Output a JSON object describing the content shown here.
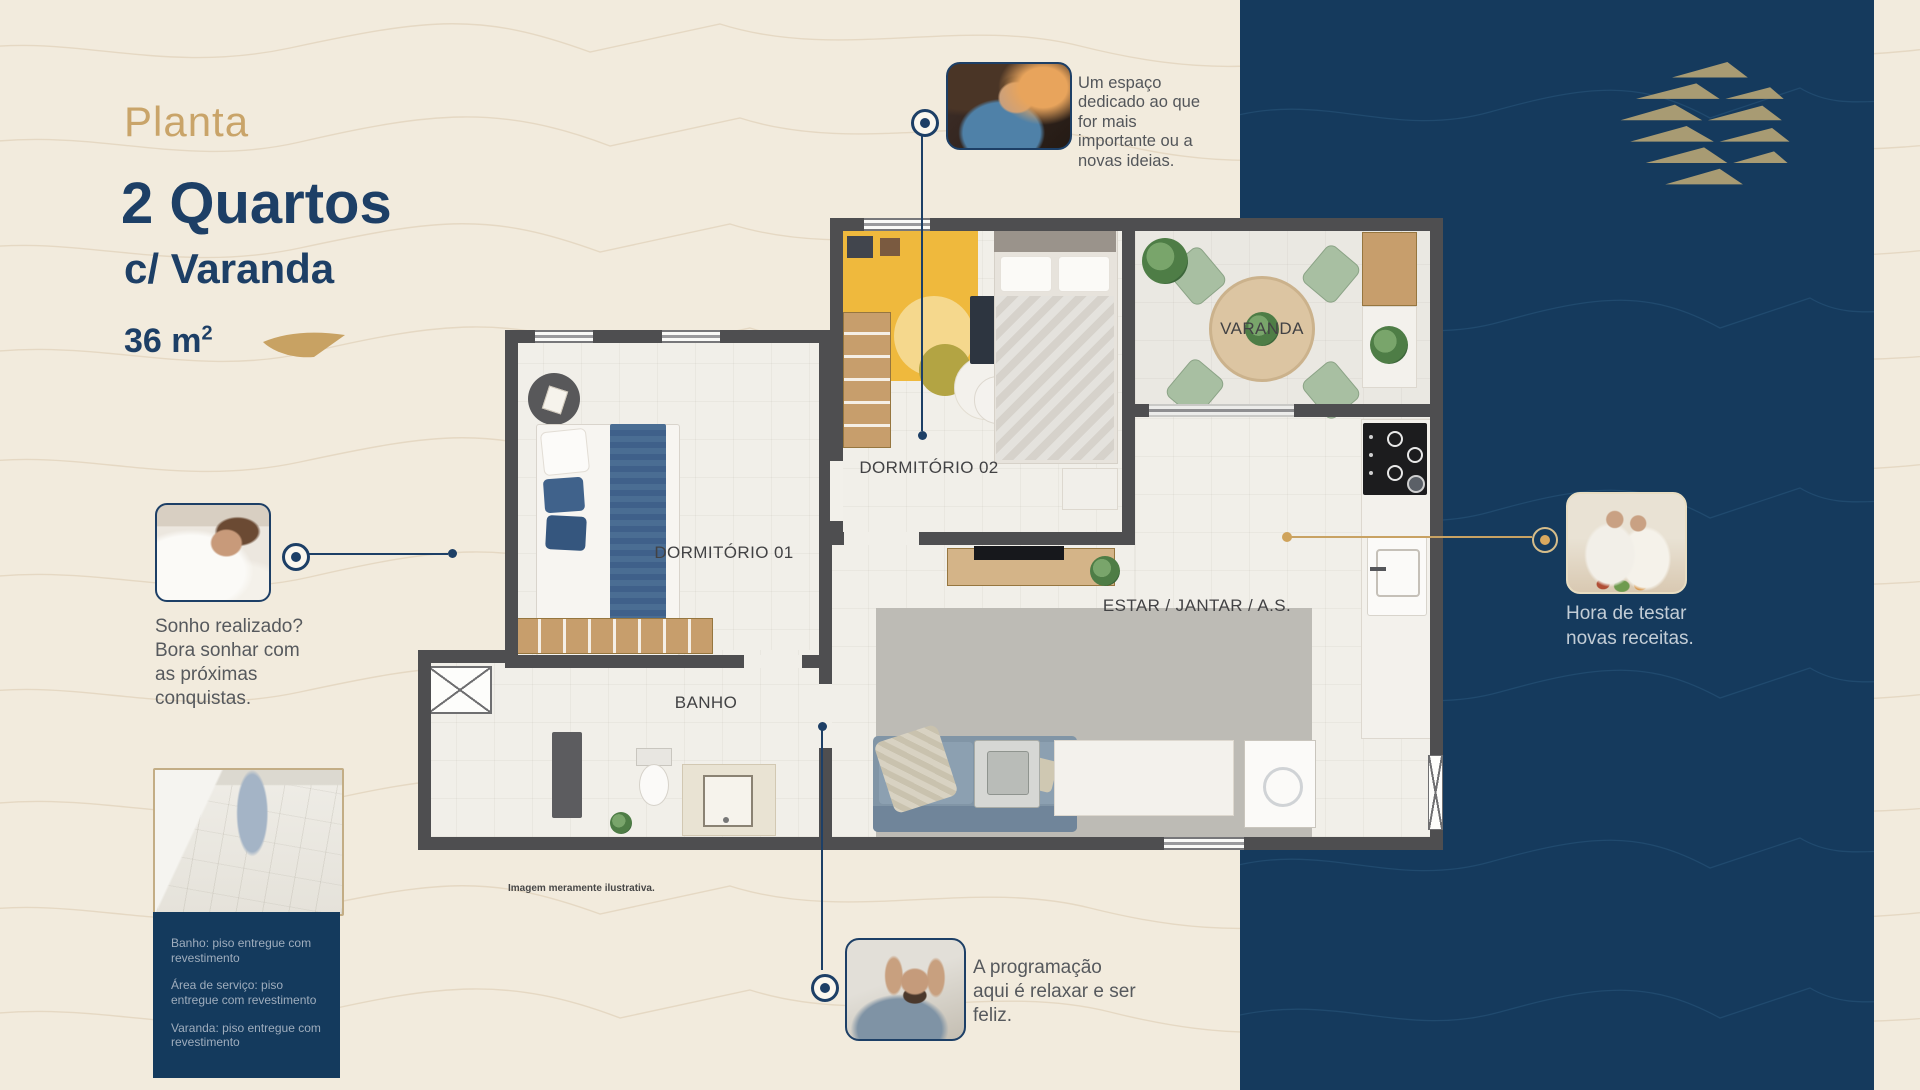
{
  "meta": {
    "description": "Real estate floor plan brochure slide",
    "language": "pt-BR"
  },
  "palette": {
    "background_cream": "#f2ebdd",
    "panel_navy": "#153a5d",
    "title_navy": "#1d3f66",
    "accent_gold": "#c8a263",
    "logo_gold": "#a89b73",
    "body_gray": "#56595d",
    "finishes_text": "#9fadbd",
    "wall_gray": "#4e4e50"
  },
  "header": {
    "eyebrow": "Planta",
    "title": "2 Quartos",
    "subtitle": "c/ Varanda",
    "area": "36 m",
    "area_sup": "2"
  },
  "floorplan": {
    "labels": {
      "dorm01": "DORMITÓRIO 01",
      "dorm02": "DORMITÓRIO 02",
      "banho": "BANHO",
      "estar": "ESTAR / JANTAR / A.S.",
      "varanda": "VARANDA"
    },
    "disclaimer": "Imagem meramente ilustrativa."
  },
  "callouts": {
    "office": {
      "photo": "man-working-at-laptop",
      "text": "Um espaço dedicado ao que for mais importante ou a novas ideias."
    },
    "bedroom": {
      "photo": "woman-resting-in-bed",
      "text": "Sonho realizado? Bora sonhar com as próximas conquistas."
    },
    "kitchen": {
      "photo": "couple-cooking-together",
      "text": "Hora de testar novas receitas."
    },
    "living": {
      "photo": "man-relaxing-on-sofa",
      "text": "A programação aqui é relaxar e ser feliz."
    }
  },
  "finishes": {
    "photo": "delivered-bathroom-floor",
    "items": [
      "Banho: piso entregue com revestimento",
      "Área de serviço: piso entregue com revestimento",
      "Varanda: piso entregue com revestimento"
    ]
  },
  "brand": {
    "logo": "gold-triangle-waves-logo"
  }
}
